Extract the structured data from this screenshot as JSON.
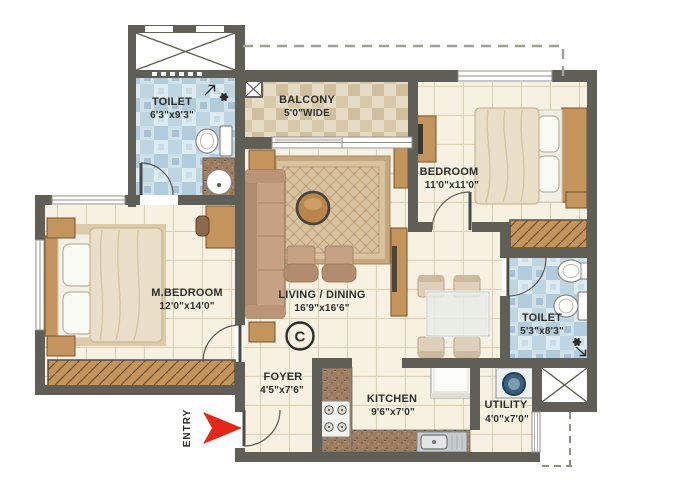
{
  "rooms": {
    "toilet_top": {
      "name": "TOILET",
      "dims": "6'3\"x9'3\""
    },
    "balcony": {
      "name": "BALCONY",
      "dims": "5'0\"WIDE"
    },
    "bedroom": {
      "name": "BEDROOM",
      "dims": "11'0\"x11'0\""
    },
    "master_bedroom": {
      "name": "M.BEDROOM",
      "dims": "12'0\"x14'0\""
    },
    "living_dining": {
      "name": "LIVING / DINING",
      "dims": "16'9\"x16'6\""
    },
    "toilet_right": {
      "name": "TOILET",
      "dims": "5'3\"x8'3\""
    },
    "foyer": {
      "name": "FOYER",
      "dims": "4'5\"x7'6\""
    },
    "kitchen": {
      "name": "KITCHEN",
      "dims": "9'6\"x7'0\""
    },
    "utility": {
      "name": "UTILITY",
      "dims": "4'0\"x7'0\""
    }
  },
  "entry": {
    "label": "ENTRY",
    "arrow_color": "#e42619"
  },
  "annotations": {
    "copyright_mark": "C"
  },
  "colors": {
    "wall": "#5f5f57",
    "floor": "#f7f1e2",
    "toilet_floor": "#cfe2ec",
    "balcony_floor": "#e5dbc4",
    "wood": "#c3955d",
    "sofa": "#c7a183",
    "label_text": "#2e2e2a"
  },
  "icons": {
    "entry": "entry-arrow-icon",
    "vents": "exhaust-fan-icon",
    "shafts": "shaft-cross-icon"
  }
}
